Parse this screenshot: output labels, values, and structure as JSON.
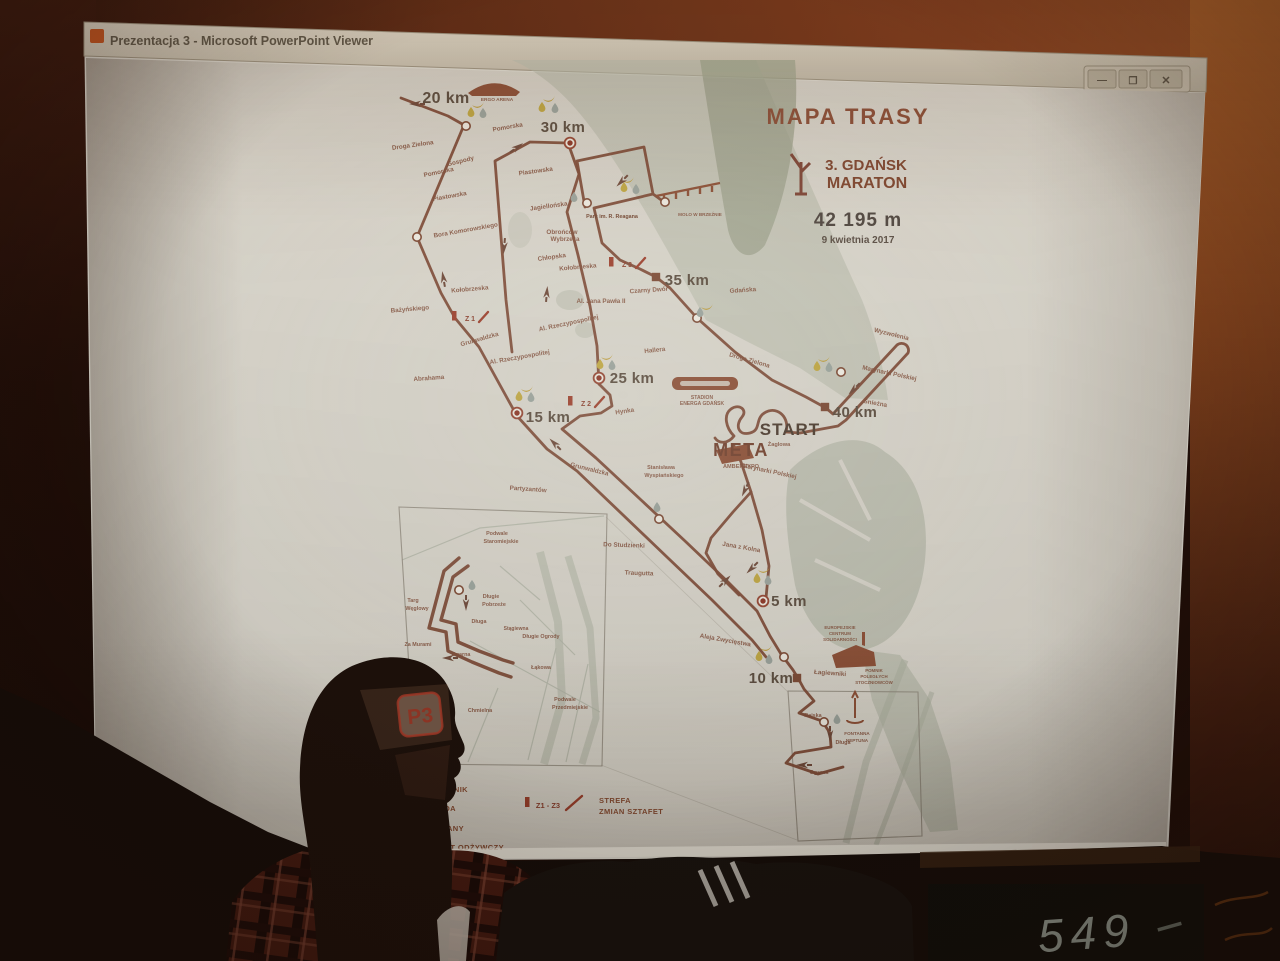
{
  "window": {
    "title": "Prezentacja 3 - Microsoft PowerPoint Viewer",
    "controls": [
      {
        "name": "minimize",
        "glyph": "—"
      },
      {
        "name": "maximize",
        "glyph": "❐"
      },
      {
        "name": "close",
        "glyph": "✕"
      }
    ]
  },
  "slide": {
    "title": "MAPA TRASY",
    "event_line1": "3. GDAŃSK",
    "event_line2": "MARATON",
    "distance": "42 195 m",
    "date": "9 kwietnia 2017",
    "legend": {
      "zone_label": "Z1 - Z3",
      "strefa1": "STREFA",
      "strefa2": "ZMIAN SZTAFET",
      "items": [
        {
          "t": "IZOTONIK",
          "x": 468,
          "y": 792
        },
        {
          "t": "WODA",
          "x": 456,
          "y": 811
        },
        {
          "t": "BANANY",
          "x": 464,
          "y": 831
        },
        {
          "t": "PUNKT ODŻYWCZY",
          "x": 504,
          "y": 850
        }
      ]
    },
    "map": {
      "labels": [
        {
          "t": "20 km",
          "x": 446,
          "y": 103,
          "k": "km",
          "s": 16
        },
        {
          "t": "30 km",
          "x": 563,
          "y": 132,
          "k": "km",
          "s": 15
        },
        {
          "t": "35 km",
          "x": 687,
          "y": 285,
          "k": "km",
          "s": 15
        },
        {
          "t": "25 km",
          "x": 632,
          "y": 383,
          "k": "km",
          "s": 15
        },
        {
          "t": "15 km",
          "x": 548,
          "y": 422,
          "k": "km",
          "s": 15
        },
        {
          "t": "40 km",
          "x": 855,
          "y": 417,
          "k": "km",
          "s": 15
        },
        {
          "t": "5 km",
          "x": 789,
          "y": 606,
          "k": "km",
          "s": 15
        },
        {
          "t": "10 km",
          "x": 771,
          "y": 683,
          "k": "km",
          "s": 15
        },
        {
          "t": "START",
          "x": 790,
          "y": 435,
          "k": "start",
          "s": 17
        },
        {
          "t": "Żaglowa",
          "x": 779,
          "y": 446,
          "s": 5.6
        },
        {
          "t": "META",
          "x": 741,
          "y": 456,
          "k": "meta",
          "s": 18
        },
        {
          "t": "AMBEREXPO",
          "x": 741,
          "y": 468,
          "s": 5.6
        },
        {
          "t": "STADION",
          "x": 702,
          "y": 399,
          "s": 5
        },
        {
          "t": "ENERGA GDAŃSK",
          "x": 702,
          "y": 405,
          "s": 5
        },
        {
          "t": "ERGO ARENA",
          "x": 497,
          "y": 101,
          "s": 4.8
        },
        {
          "t": "Droga Zielona",
          "x": 413,
          "y": 147,
          "a": -8
        },
        {
          "t": "Gospody",
          "x": 461,
          "y": 163,
          "a": -14
        },
        {
          "t": "Pomorska",
          "x": 508,
          "y": 129,
          "a": -10
        },
        {
          "t": "Piastowska",
          "x": 536,
          "y": 173,
          "a": -8
        },
        {
          "t": "Pomorska",
          "x": 439,
          "y": 174,
          "a": -12
        },
        {
          "t": "Piastowska",
          "x": 450,
          "y": 198,
          "a": -10
        },
        {
          "t": "Jagiellońska",
          "x": 549,
          "y": 208,
          "a": -8
        },
        {
          "t": "Obrońców",
          "x": 562,
          "y": 234
        },
        {
          "t": "Wybrzeża",
          "x": 565,
          "y": 241
        },
        {
          "t": "Chłopska",
          "x": 552,
          "y": 259,
          "a": -8
        },
        {
          "t": "Kołobrzeska",
          "x": 578,
          "y": 269,
          "a": -5
        },
        {
          "t": "Bora Komorowskiego",
          "x": 466,
          "y": 232,
          "a": -10
        },
        {
          "t": "Kołobrzeska",
          "x": 470,
          "y": 291,
          "a": -5
        },
        {
          "t": "Bażyńskiego",
          "x": 410,
          "y": 311,
          "a": -5
        },
        {
          "t": "Grunwaldzka",
          "x": 480,
          "y": 341,
          "a": -16
        },
        {
          "t": "Al. Rzeczypospolitej",
          "x": 569,
          "y": 325,
          "a": -12
        },
        {
          "t": "Al. Jana Pawła II",
          "x": 601,
          "y": 303
        },
        {
          "t": "Abrahama",
          "x": 429,
          "y": 380,
          "a": -4
        },
        {
          "t": "Al. Rzeczypospolitej",
          "x": 520,
          "y": 359,
          "a": -10
        },
        {
          "t": "Hallera",
          "x": 655,
          "y": 352,
          "a": -6
        },
        {
          "t": "Hynka",
          "x": 625,
          "y": 413,
          "a": -8
        },
        {
          "t": "Czarny Dwór",
          "x": 649,
          "y": 292,
          "a": -4
        },
        {
          "t": "Gdańska",
          "x": 743,
          "y": 292,
          "a": -4
        },
        {
          "t": "Park im. R. Reagana",
          "x": 612,
          "y": 218,
          "s": 5.4,
          "k": "parkl"
        },
        {
          "t": "MOLO W BRZEŹNIE",
          "x": 700,
          "y": 216,
          "s": 4.6
        },
        {
          "t": "Droga Zielona",
          "x": 749,
          "y": 362,
          "a": 16
        },
        {
          "t": "Wyzwolenia",
          "x": 891,
          "y": 336,
          "a": 14
        },
        {
          "t": "Marynarki Polskiej",
          "x": 889,
          "y": 375,
          "a": 12
        },
        {
          "t": "Śnieżna",
          "x": 875,
          "y": 405,
          "a": 10
        },
        {
          "t": "Marynarki Polskiej",
          "x": 769,
          "y": 473,
          "a": 12
        },
        {
          "t": "Grunwaldzka",
          "x": 589,
          "y": 471,
          "a": 14
        },
        {
          "t": "Stanisława",
          "x": 661,
          "y": 469,
          "s": 5.4
        },
        {
          "t": "Wyspiańskiego",
          "x": 664,
          "y": 477,
          "s": 5.4
        },
        {
          "t": "Partyzantów",
          "x": 528,
          "y": 491,
          "a": 4
        },
        {
          "t": "Do Studzienki",
          "x": 624,
          "y": 547,
          "a": 2
        },
        {
          "t": "Traugutta",
          "x": 639,
          "y": 575,
          "a": 2
        },
        {
          "t": "Jana z Kolna",
          "x": 741,
          "y": 549,
          "a": 10
        },
        {
          "t": "Aleja Zwycięstwa",
          "x": 725,
          "y": 642,
          "a": 10
        },
        {
          "t": "Łagiewniki",
          "x": 830,
          "y": 675,
          "a": 4
        },
        {
          "t": "EUROPEJSKIE",
          "x": 840,
          "y": 629,
          "s": 4.4
        },
        {
          "t": "CENTRUM",
          "x": 840,
          "y": 635,
          "s": 4.4
        },
        {
          "t": "SOLIDARNOŚCI",
          "x": 840,
          "y": 641,
          "s": 4.4
        },
        {
          "t": "POMNIK",
          "x": 874,
          "y": 672,
          "s": 4.4
        },
        {
          "t": "POLEGŁYCH",
          "x": 874,
          "y": 678,
          "s": 4.4
        },
        {
          "t": "STOCZNIOWCÓW",
          "x": 874,
          "y": 684,
          "s": 4.4
        },
        {
          "t": "Rajska",
          "x": 813,
          "y": 717,
          "s": 5.4
        },
        {
          "t": "Długa",
          "x": 843,
          "y": 744,
          "s": 5.4
        },
        {
          "t": "FONTANNA",
          "x": 857,
          "y": 735,
          "s": 4.6
        },
        {
          "t": "NEPTUNA",
          "x": 857,
          "y": 742,
          "s": 4.6
        },
        {
          "t": "Ogarna",
          "x": 819,
          "y": 774,
          "s": 5.4
        },
        {
          "t": "Podwale",
          "x": 497,
          "y": 535,
          "s": 5.4
        },
        {
          "t": "Staromiejskie",
          "x": 501,
          "y": 543,
          "s": 5.4
        },
        {
          "t": "Targ",
          "x": 413,
          "y": 602,
          "s": 5.4
        },
        {
          "t": "Węglowy",
          "x": 417,
          "y": 610,
          "s": 5.4
        },
        {
          "t": "Długie",
          "x": 491,
          "y": 598,
          "s": 5.4
        },
        {
          "t": "Pobrzeże",
          "x": 494,
          "y": 606,
          "s": 5.4
        },
        {
          "t": "Długa",
          "x": 479,
          "y": 623,
          "s": 5.4
        },
        {
          "t": "Stągiewna",
          "x": 516,
          "y": 630,
          "s": 5
        },
        {
          "t": "Długie Ogrody",
          "x": 541,
          "y": 638,
          "s": 5.4
        },
        {
          "t": "Za Murami",
          "x": 418,
          "y": 646,
          "s": 5.4
        },
        {
          "t": "Ogarna",
          "x": 461,
          "y": 656,
          "s": 5.4
        },
        {
          "t": "Łąkowa",
          "x": 541,
          "y": 669,
          "s": 5.4
        },
        {
          "t": "Chmielna",
          "x": 480,
          "y": 712,
          "s": 5.4
        },
        {
          "t": "Podwale",
          "x": 565,
          "y": 701,
          "s": 5.4
        },
        {
          "t": "Przedmiejskie",
          "x": 570,
          "y": 709,
          "s": 5.4
        },
        {
          "t": "Z 1",
          "x": 470,
          "y": 321,
          "k": "zl",
          "s": 7
        },
        {
          "t": "Z 2",
          "x": 586,
          "y": 406,
          "k": "zl",
          "s": 7
        },
        {
          "t": "Z 3",
          "x": 627,
          "y": 267,
          "k": "zl",
          "s": 7
        }
      ],
      "zones": [
        {
          "x": 470,
          "y": 321
        },
        {
          "x": 586,
          "y": 406
        },
        {
          "x": 627,
          "y": 267
        }
      ],
      "stations": [
        {
          "x": 466,
          "y": 126
        },
        {
          "x": 417,
          "y": 237
        },
        {
          "x": 587,
          "y": 203
        },
        {
          "x": 665,
          "y": 202
        },
        {
          "x": 697,
          "y": 318
        },
        {
          "x": 841,
          "y": 372
        },
        {
          "x": 659,
          "y": 519
        },
        {
          "x": 784,
          "y": 657
        },
        {
          "x": 459,
          "y": 590
        },
        {
          "x": 824,
          "y": 722
        }
      ],
      "markers": [
        {
          "x": 570,
          "y": 143,
          "t": "dot"
        },
        {
          "x": 599,
          "y": 378,
          "t": "dot"
        },
        {
          "x": 517,
          "y": 413,
          "t": "dot"
        },
        {
          "x": 763,
          "y": 601,
          "t": "dot"
        },
        {
          "x": 656,
          "y": 277,
          "t": "sq"
        },
        {
          "x": 825,
          "y": 407,
          "t": "sq"
        },
        {
          "x": 797,
          "y": 678,
          "t": "sq"
        }
      ],
      "icons": [
        {
          "t": "banana",
          "x": 478,
          "y": 104
        },
        {
          "t": "dropy",
          "x": 471,
          "y": 112
        },
        {
          "t": "dropg",
          "x": 483,
          "y": 113
        },
        {
          "t": "banana",
          "x": 549,
          "y": 98
        },
        {
          "t": "dropy",
          "x": 542,
          "y": 107
        },
        {
          "t": "dropg",
          "x": 555,
          "y": 108
        },
        {
          "t": "banana",
          "x": 628,
          "y": 179
        },
        {
          "t": "dropy",
          "x": 624,
          "y": 187
        },
        {
          "t": "dropg",
          "x": 636,
          "y": 189
        },
        {
          "t": "dropg",
          "x": 574,
          "y": 197
        },
        {
          "t": "banana",
          "x": 607,
          "y": 356
        },
        {
          "t": "dropy",
          "x": 600,
          "y": 364
        },
        {
          "t": "dropg",
          "x": 612,
          "y": 365
        },
        {
          "t": "banana",
          "x": 527,
          "y": 388
        },
        {
          "t": "dropy",
          "x": 519,
          "y": 396
        },
        {
          "t": "dropg",
          "x": 531,
          "y": 397
        },
        {
          "t": "banana",
          "x": 824,
          "y": 358
        },
        {
          "t": "dropy",
          "x": 817,
          "y": 366
        },
        {
          "t": "dropg",
          "x": 829,
          "y": 367
        },
        {
          "t": "banana",
          "x": 707,
          "y": 306
        },
        {
          "t": "dropg",
          "x": 700,
          "y": 312
        },
        {
          "t": "banana",
          "x": 764,
          "y": 569
        },
        {
          "t": "dropy",
          "x": 757,
          "y": 578
        },
        {
          "t": "dropg",
          "x": 768,
          "y": 580
        },
        {
          "t": "banana",
          "x": 766,
          "y": 647
        },
        {
          "t": "dropy",
          "x": 759,
          "y": 656
        },
        {
          "t": "dropg",
          "x": 769,
          "y": 659
        },
        {
          "t": "dropg",
          "x": 657,
          "y": 507
        },
        {
          "t": "dropg",
          "x": 472,
          "y": 585
        },
        {
          "t": "dropg",
          "x": 837,
          "y": 719
        }
      ],
      "arrows": [
        {
          "x": 414,
          "y": 104,
          "r": 180
        },
        {
          "x": 519,
          "y": 146,
          "r": -35
        },
        {
          "x": 620,
          "y": 183,
          "r": 135
        },
        {
          "x": 443,
          "y": 276,
          "r": -100
        },
        {
          "x": 504,
          "y": 249,
          "r": 95
        },
        {
          "x": 547,
          "y": 291,
          "r": -85
        },
        {
          "x": 553,
          "y": 442,
          "r": -135
        },
        {
          "x": 744,
          "y": 492,
          "r": 115
        },
        {
          "x": 852,
          "y": 391,
          "r": 135
        },
        {
          "x": 727,
          "y": 579,
          "r": -45
        },
        {
          "x": 750,
          "y": 570,
          "r": 135
        },
        {
          "x": 830,
          "y": 737,
          "r": 90
        },
        {
          "x": 801,
          "y": 765,
          "r": 180
        },
        {
          "x": 466,
          "y": 606,
          "r": 90
        },
        {
          "x": 447,
          "y": 658,
          "r": 180
        }
      ]
    }
  },
  "photo": {
    "handwriting": "549",
    "forehead_logo": "P3"
  }
}
